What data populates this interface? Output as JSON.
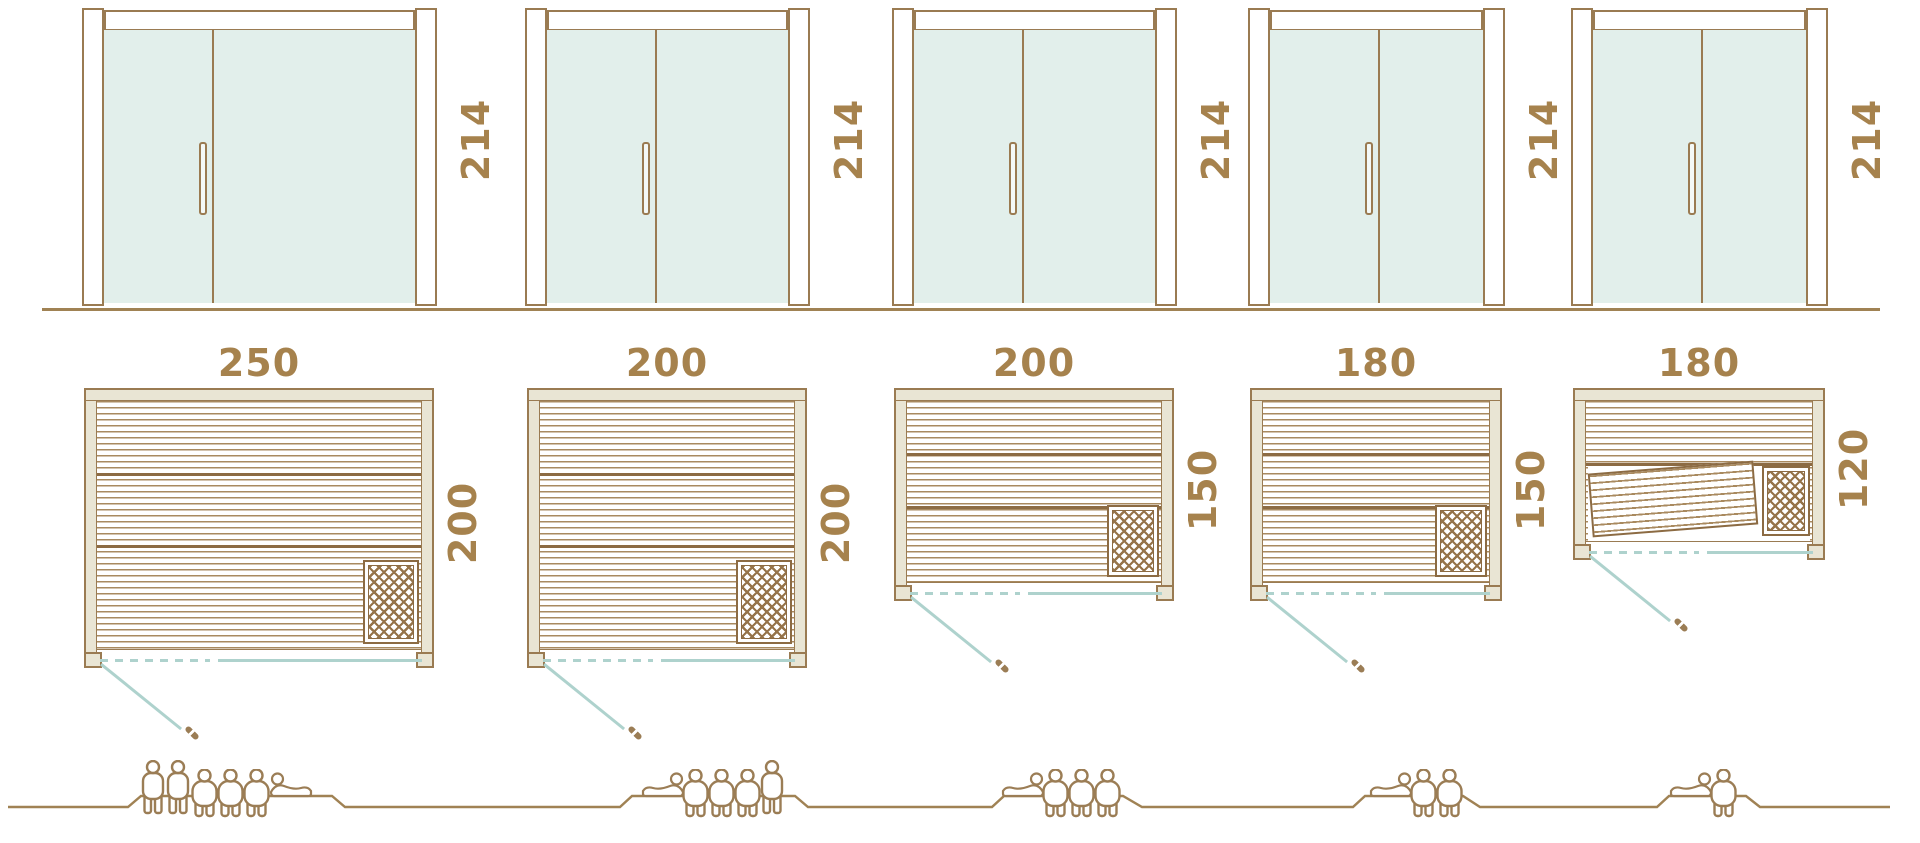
{
  "diagram_title": "sauna-size-comparison",
  "door_height_label": "214",
  "colors": {
    "outline_brown": "#9a7b52",
    "text_gold": "#a6824d",
    "glass_teal": "#e2efeb",
    "wall_beige": "#e9e5d4",
    "door_swing_teal": "#aed2cd",
    "plank_brown": "#a98a5f",
    "dark_plank_brown": "#8c6b43",
    "ground_brown": "#a08254"
  },
  "columns": [
    {
      "width_label": "250",
      "depth_label": "200",
      "height_label": "214",
      "width_cm": 250,
      "depth_cm": 200,
      "height_cm": 214,
      "heater": true,
      "tilted_bench": false,
      "people": [
        "standing",
        "standing",
        "seated",
        "seated",
        "seated",
        "reclining"
      ]
    },
    {
      "width_label": "200",
      "depth_label": "200",
      "height_label": "214",
      "width_cm": 200,
      "depth_cm": 200,
      "height_cm": 214,
      "heater": true,
      "tilted_bench": false,
      "people": [
        "reclining",
        "seated",
        "seated",
        "seated",
        "standing"
      ]
    },
    {
      "width_label": "200",
      "depth_label": "150",
      "height_label": "214",
      "width_cm": 200,
      "depth_cm": 150,
      "height_cm": 214,
      "heater": true,
      "tilted_bench": false,
      "people": [
        "reclining",
        "seated",
        "seated",
        "seated"
      ]
    },
    {
      "width_label": "180",
      "depth_label": "150",
      "height_label": "214",
      "width_cm": 180,
      "depth_cm": 150,
      "height_cm": 214,
      "heater": true,
      "tilted_bench": false,
      "people": [
        "reclining",
        "seated",
        "seated"
      ]
    },
    {
      "width_label": "180",
      "depth_label": "120",
      "height_label": "214",
      "width_cm": 180,
      "depth_cm": 120,
      "height_cm": 214,
      "heater": true,
      "tilted_bench": true,
      "people": [
        "reclining",
        "seated"
      ]
    }
  ]
}
